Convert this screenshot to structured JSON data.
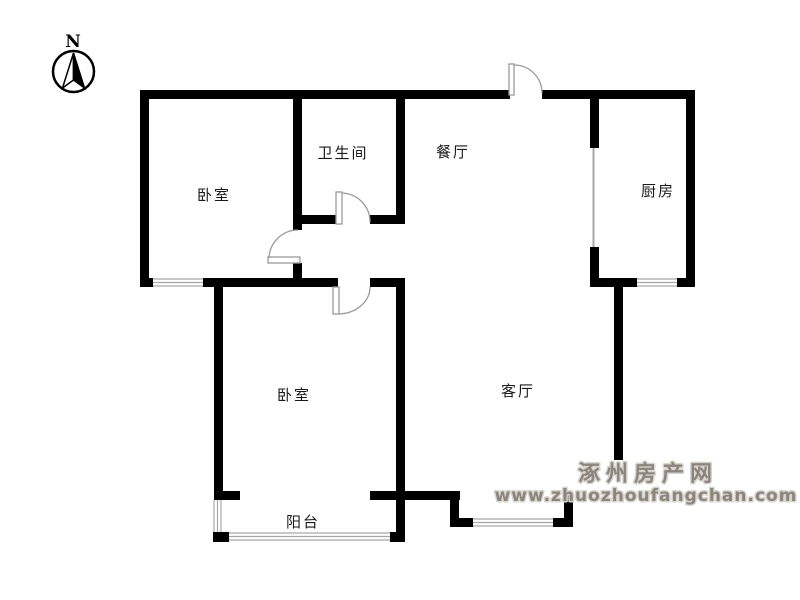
{
  "compass": {
    "north_label": "N"
  },
  "room_labels": {
    "bedroom_top": "卧室",
    "bathroom": "卫生间",
    "dining": "餐厅",
    "kitchen": "厨房",
    "bedroom_bottom": "卧室",
    "living_room": "客厅",
    "balcony": "阳台"
  },
  "watermark": {
    "site_name": "涿州房产网",
    "site_url": "www.zhuozhoufangchan.com"
  },
  "colors": {
    "background": "#ffffff",
    "wall": "#000000",
    "door_line": "#9a9a9a",
    "window_line": "#a6a6a6",
    "label_text": "#1a1a1a",
    "watermark_fill": "#8b857d",
    "watermark_outline": "#d8d4ce"
  }
}
